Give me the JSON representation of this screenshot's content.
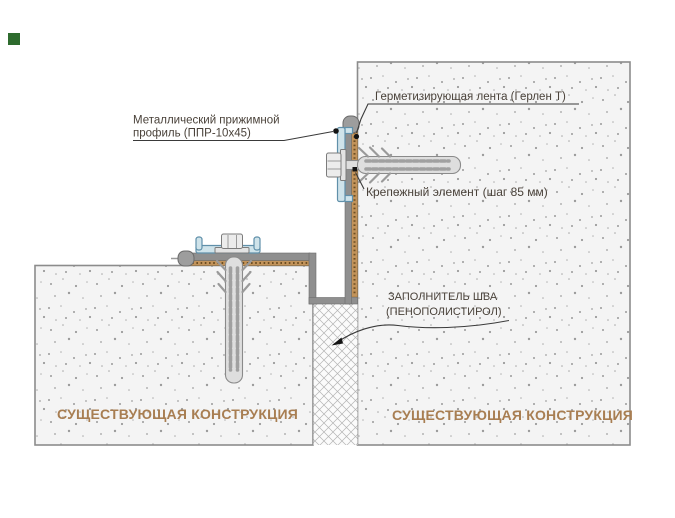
{
  "labels": {
    "pressure_profile_line1": "Металлический прижимной",
    "pressure_profile_line2": "профиль  (ППР-10х45)",
    "sealing_tape": "Герметизирующая лента  (Герлен Т)",
    "fastener": "Крепежный элемент (шаг 85 мм)",
    "joint_filler_line1": "ЗАПОЛНИТЕЛЬ ШВА",
    "joint_filler_line2": "(ПЕНОПОЛИСТИРОЛ)",
    "existing_structure_left": "СУЩЕСТВУЮЩАЯ КОНСТРУКЦИЯ",
    "existing_structure_right": "СУЩЕСТВУЮЩАЯ КОНСТРУКЦИЯ"
  },
  "colors": {
    "annotation_text": "#4a423a",
    "existing_structure_text": "#a87e52",
    "concrete_fill": "#f4f4f4",
    "concrete_border": "#8c8c8c",
    "membrane_gray": "#8f8f8f",
    "gerlen_tape_tan": "#c2935a",
    "pressure_profile_blue": "#cfe3ea",
    "pressure_profile_outline": "#6090aa",
    "fastener_metal": "#e3e3e3",
    "joint_filler_hatch": "#b4b4b4",
    "leader_line": "#3a3a3a",
    "corner_marker_green": "#2e6b2e"
  }
}
